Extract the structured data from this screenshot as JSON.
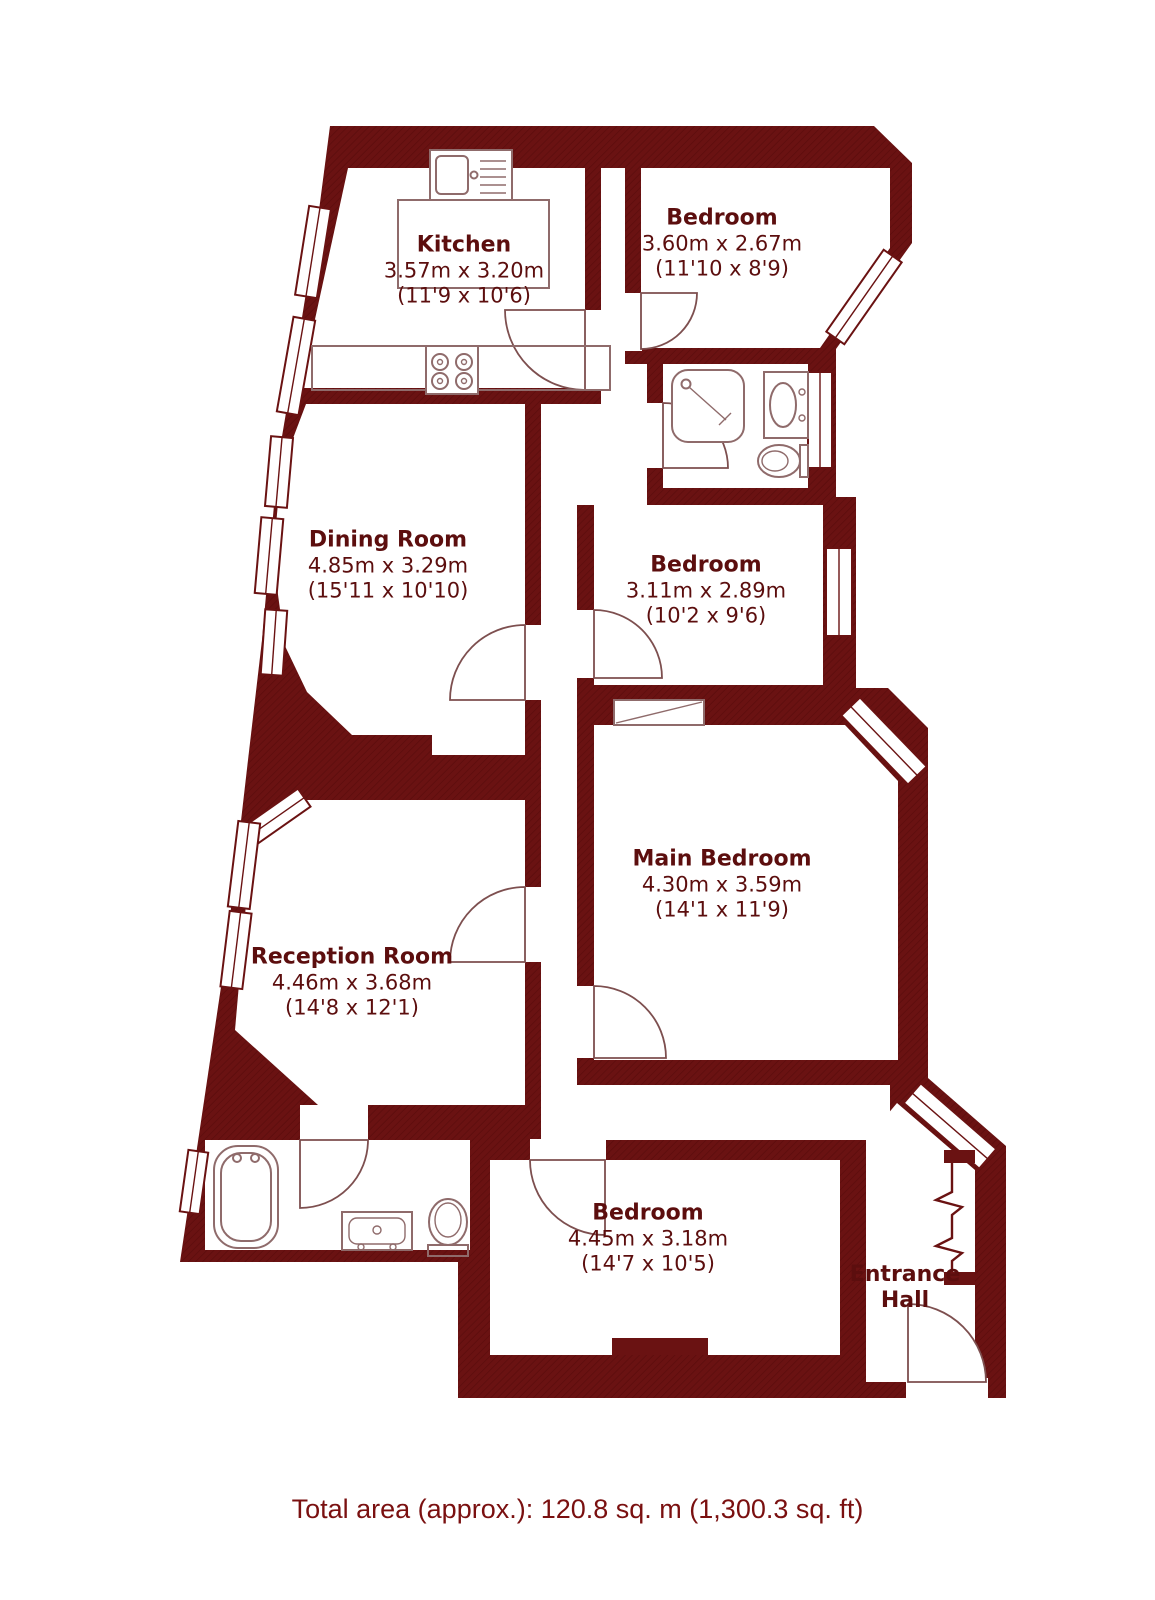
{
  "meta": {
    "kind": "residential floor plan",
    "wall_style": "solid dark maroon with diagonal hatch"
  },
  "colors": {
    "wall_base": "#6a1212",
    "wall_hatch": "#5c0d0d",
    "label_text": "#5c0e0e",
    "footer_text": "#7a1010",
    "door_line": "#7d4f4f",
    "fixture_line": "#8f6b6b",
    "window_line": "#6a1212",
    "floor": "#ffffff"
  },
  "rooms": [
    {
      "id": "kitchen",
      "name": "Kitchen",
      "metric": "3.57m x 3.20m",
      "imperial": "(11'9 x 10'6)"
    },
    {
      "id": "bedroom-top",
      "name": "Bedroom",
      "metric": "3.60m x 2.67m",
      "imperial": "(11'10 x 8'9)"
    },
    {
      "id": "dining-room",
      "name": "Dining Room",
      "metric": "4.85m x 3.29m",
      "imperial": "(15'11 x 10'10)"
    },
    {
      "id": "bedroom-middle",
      "name": "Bedroom",
      "metric": "3.11m x 2.89m",
      "imperial": "(10'2 x 9'6)"
    },
    {
      "id": "main-bedroom",
      "name": "Main Bedroom",
      "metric": "4.30m x 3.59m",
      "imperial": "(14'1 x 11'9)"
    },
    {
      "id": "reception-room",
      "name": "Reception Room",
      "metric": "4.46m x 3.68m",
      "imperial": "(14'8 x 12'1)"
    },
    {
      "id": "bedroom-bottom",
      "name": "Bedroom",
      "metric": "4.45m x 3.18m",
      "imperial": "(14'7 x 10'5)"
    },
    {
      "id": "entrance-hall",
      "name": "Entrance Hall",
      "metric": "",
      "imperial": ""
    }
  ],
  "fixtures": [
    {
      "room": "Kitchen",
      "items": [
        "sink-with-drainer",
        "four-burner-hob",
        "worktop"
      ]
    },
    {
      "room": "Shower Room",
      "items": [
        "shower-enclosure",
        "wash-basin",
        "toilet"
      ]
    },
    {
      "room": "Bathroom",
      "items": [
        "bathtub",
        "wash-basin",
        "toilet"
      ]
    }
  ],
  "footer": {
    "total_area": "Total area (approx.): 120.8 sq. m (1,300.3 sq. ft)"
  }
}
